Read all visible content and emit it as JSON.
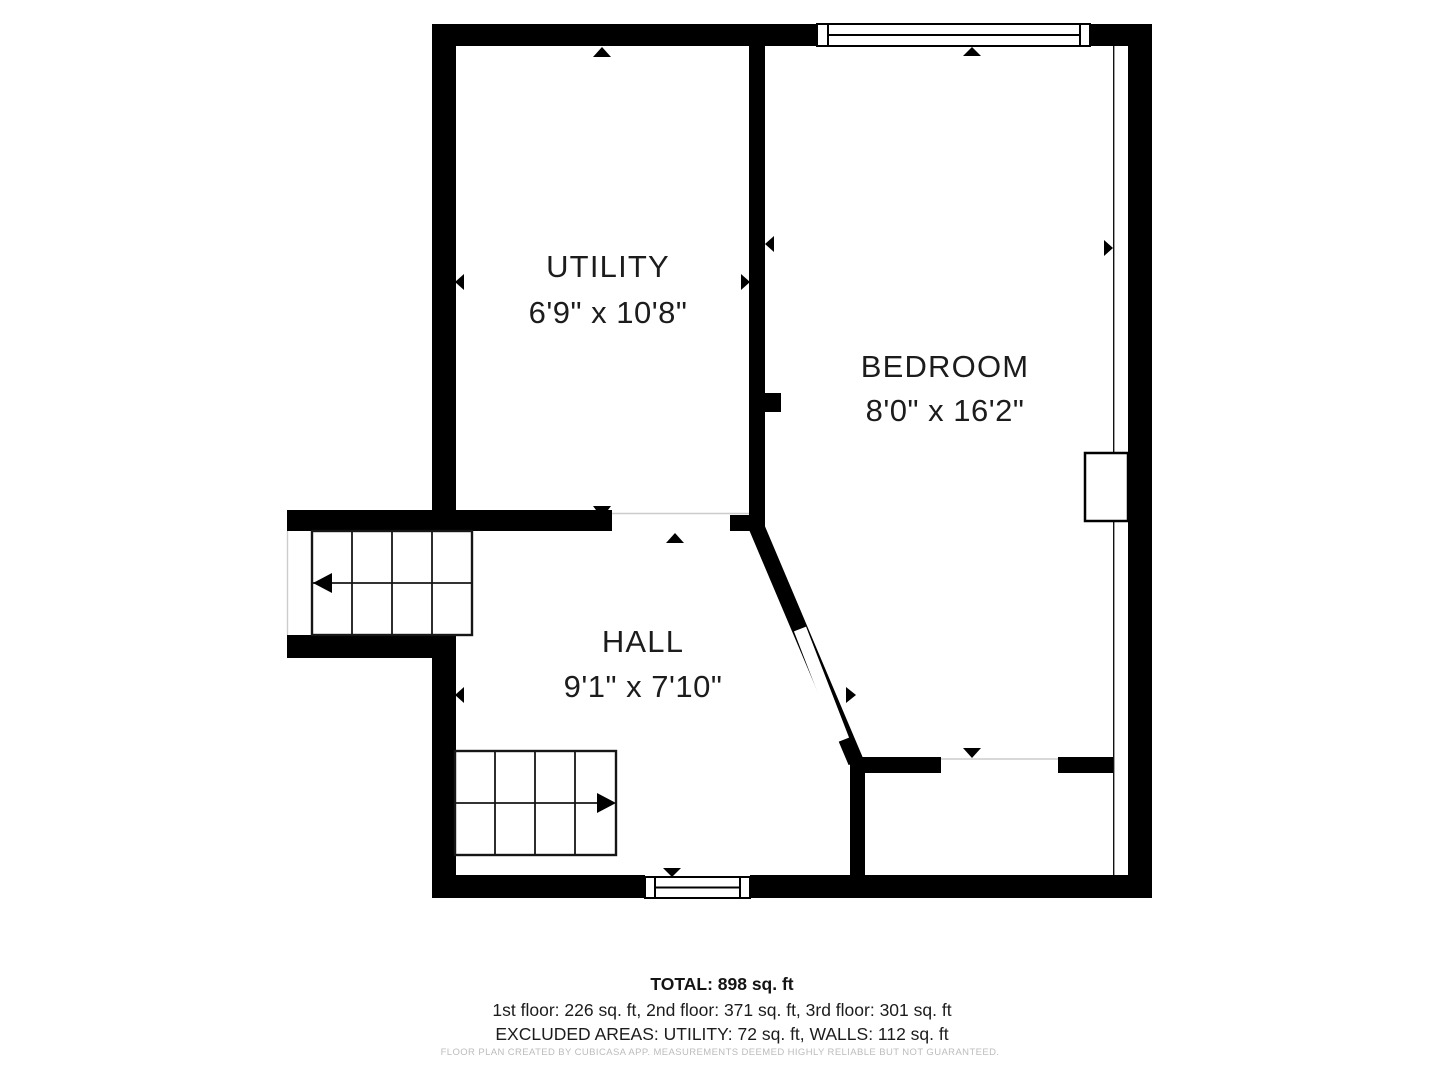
{
  "palette": {
    "background": "#ffffff",
    "walls": "#000000",
    "text": "#1c1c1c",
    "muted_footer": "#bcbcbc"
  },
  "rooms": [
    {
      "name": "UTILITY",
      "dimensions": "6'9\" x 10'8\""
    },
    {
      "name": "BEDROOM",
      "dimensions": "8'0\" x 16'2\""
    },
    {
      "name": "HALL",
      "dimensions": "9'1\" x 7'10\""
    }
  ],
  "summary": {
    "total": "TOTAL: 898 sq. ft",
    "floors": "1st floor: 226 sq. ft, 2nd floor: 371 sq. ft, 3rd floor: 301 sq. ft",
    "excluded": "EXCLUDED AREAS: UTILITY: 72 sq. ft, WALLS: 112 sq. ft"
  },
  "footer": {
    "disclaimer": "FLOOR PLAN CREATED BY CUBICASA APP. MEASUREMENTS DEEMED HIGHLY RELIABLE BUT NOT GUARANTEED."
  }
}
